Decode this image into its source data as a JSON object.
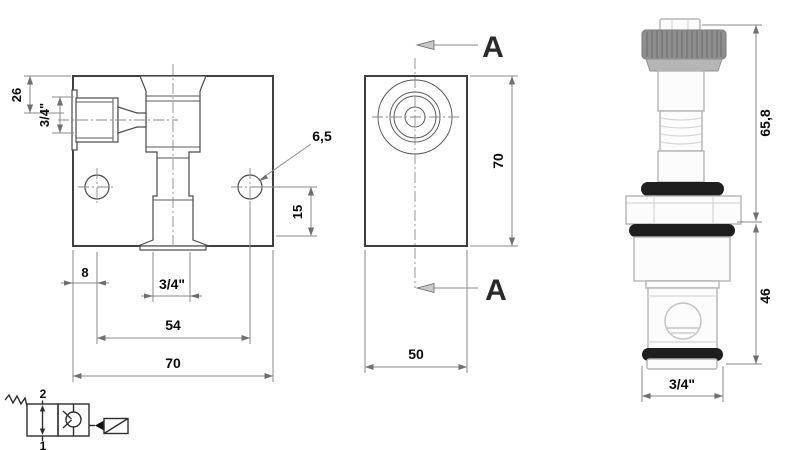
{
  "front_view": {
    "dim_top_offset": "26",
    "dim_side_port": "3/4\"",
    "dim_mount_hole": "6,5",
    "dim_hole_height": "15",
    "dim_left_offset": "8",
    "dim_bottom_port": "3/4\"",
    "dim_hole_spacing": "54",
    "dim_width": "70"
  },
  "side_view": {
    "dim_height": "70",
    "dim_depth": "50",
    "section_label_top": "A",
    "section_label_bottom": "A"
  },
  "cartridge_view": {
    "dim_upper_length": "65,8",
    "dim_lower_length": "46",
    "dim_thread": "3/4\""
  },
  "schematic_symbol": {
    "port_top": "2",
    "port_bottom": "1"
  },
  "colors": {
    "outline": "#3f3f3f",
    "dimension_line": "#8a8a8a",
    "text": "#0a0a0a",
    "o_ring": "#1e1e1e",
    "knurled_cap": "#8f8f8f",
    "background": "#ffffff"
  }
}
